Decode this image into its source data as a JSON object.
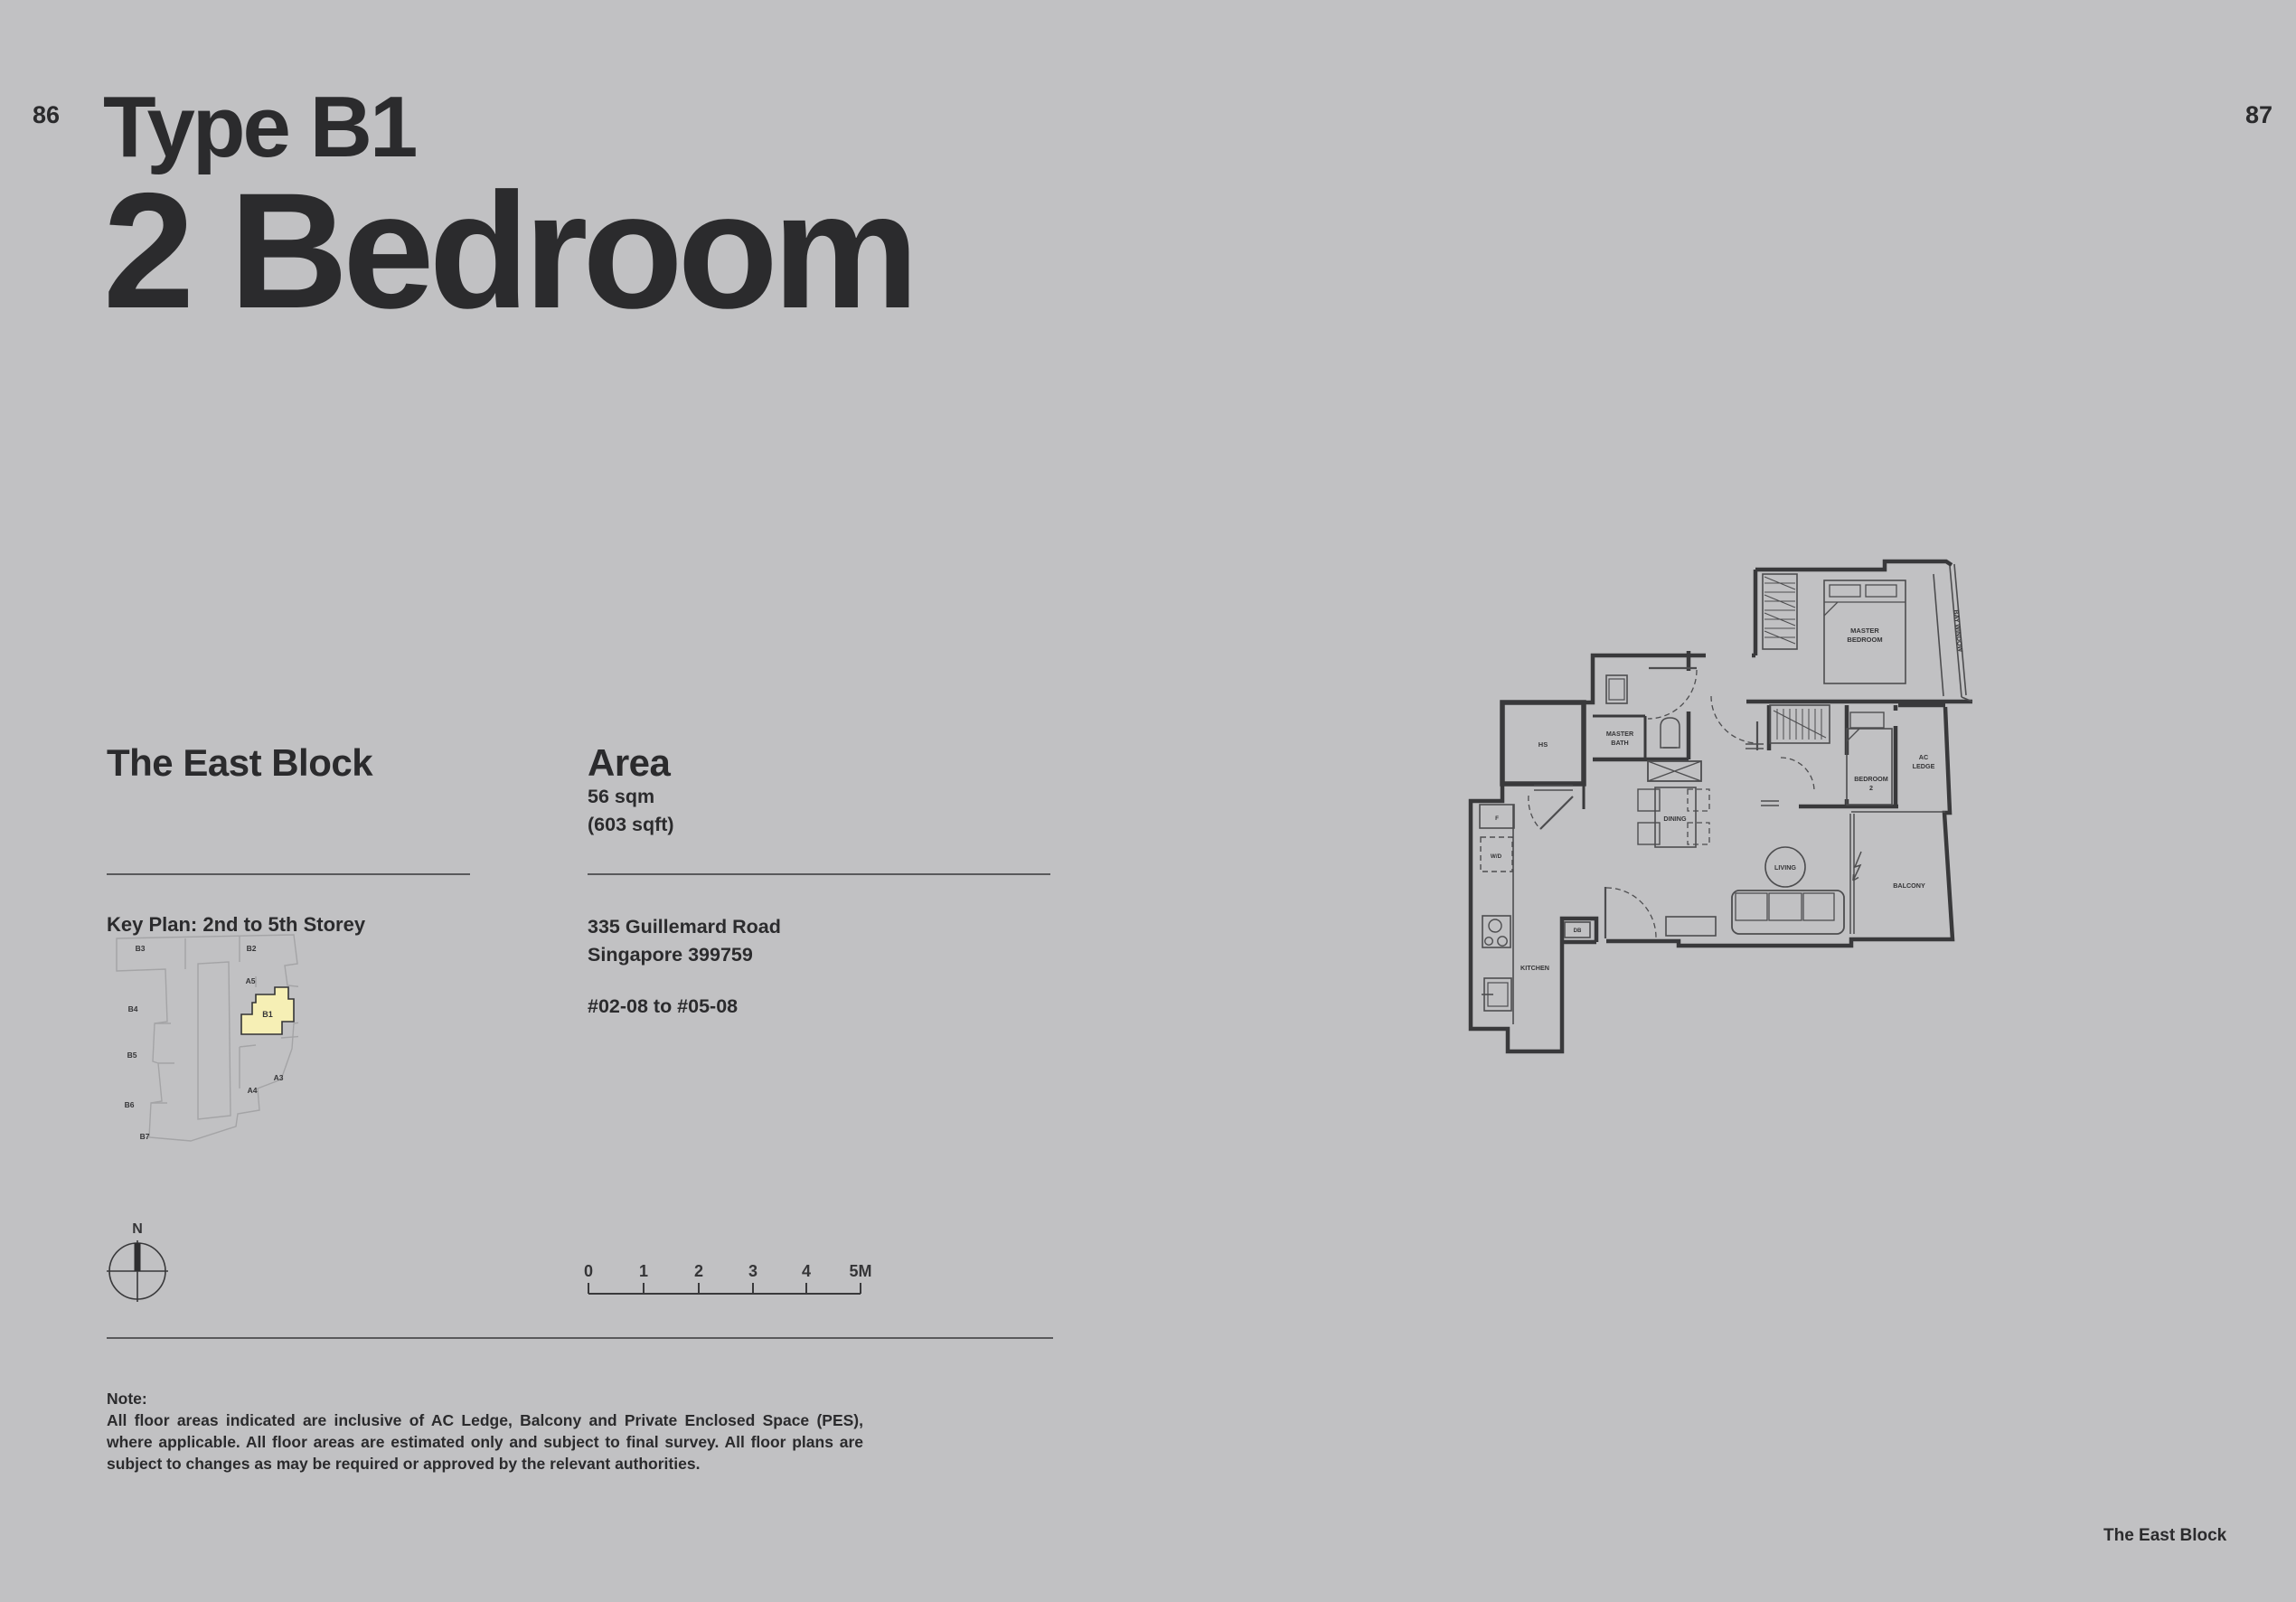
{
  "page": {
    "background": "#c1c1c3",
    "left_page_number": "86",
    "right_page_number": "87",
    "footer_label": "The East Block",
    "accent_yellow": "#f6efb5"
  },
  "title": {
    "type_label": "Type B1",
    "bedroom_label": "2 Bedroom"
  },
  "east_block": {
    "heading": "The East Block",
    "key_plan_label": "Key Plan: 2nd to 5th Storey",
    "highlighted_unit": "B1",
    "key_plan_units": [
      "B3",
      "B2",
      "B4",
      "A5",
      "B1",
      "B5",
      "A3",
      "A4",
      "B6",
      "B7"
    ]
  },
  "area": {
    "heading": "Area",
    "area_sqm": "56 sqm",
    "area_sqft": "(603 sqft)",
    "address_line_1": "335 Guillemard Road",
    "address_line_2": "Singapore 399759",
    "unit_range": "#02-08 to #05-08"
  },
  "compass": {
    "north_label": "N"
  },
  "scale_bar": {
    "ticks": [
      "0",
      "1",
      "2",
      "3",
      "4",
      "5M"
    ]
  },
  "note": {
    "heading": "Note:",
    "body": "All floor areas indicated are inclusive of AC Ledge, Balcony and Private Enclosed Space (PES), where applicable. All floor areas are estimated only and subject to final survey. All floor plans are subject to changes as may be required or approved by the relevant authorities."
  },
  "floor_plan": {
    "labels": {
      "master_bedroom_line1": "MASTER",
      "master_bedroom_line2": "BEDROOM",
      "bay_window": "BAY WINDOW",
      "master_bath_line1": "MASTER",
      "master_bath_line2": "BATH",
      "household_shelter": "HS",
      "fridge": "F",
      "washer_dryer": "W/D",
      "kitchen": "KITCHEN",
      "distribution_board": "DB",
      "dining": "DINING",
      "living": "LIVING",
      "balcony": "BALCONY",
      "bedroom2_line1": "BEDROOM",
      "bedroom2_line2": "2",
      "ac_ledge_line1": "AC",
      "ac_ledge_line2": "LEDGE"
    }
  }
}
